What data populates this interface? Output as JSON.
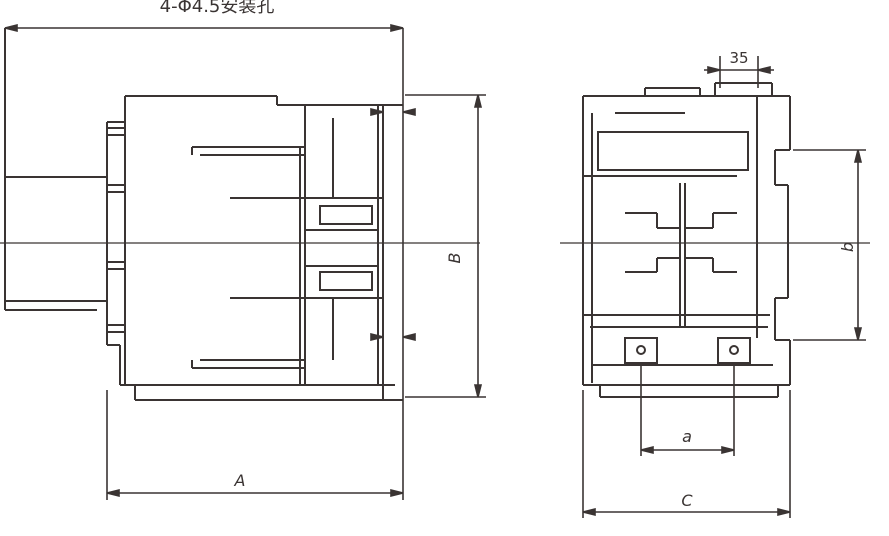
{
  "page": {
    "background": "#ffffff",
    "line_color": "#3a3433"
  },
  "drawing": {
    "type": "technical-dimension-drawing-two-views",
    "labels": {
      "mounting_holes_note": "4-Φ4.5安装孔",
      "front_width": "A",
      "front_height": "B",
      "din_rail_width": "35",
      "side_hole_spacing_vertical": "b",
      "side_hole_spacing_horizontal": "a",
      "side_depth": "C"
    }
  }
}
